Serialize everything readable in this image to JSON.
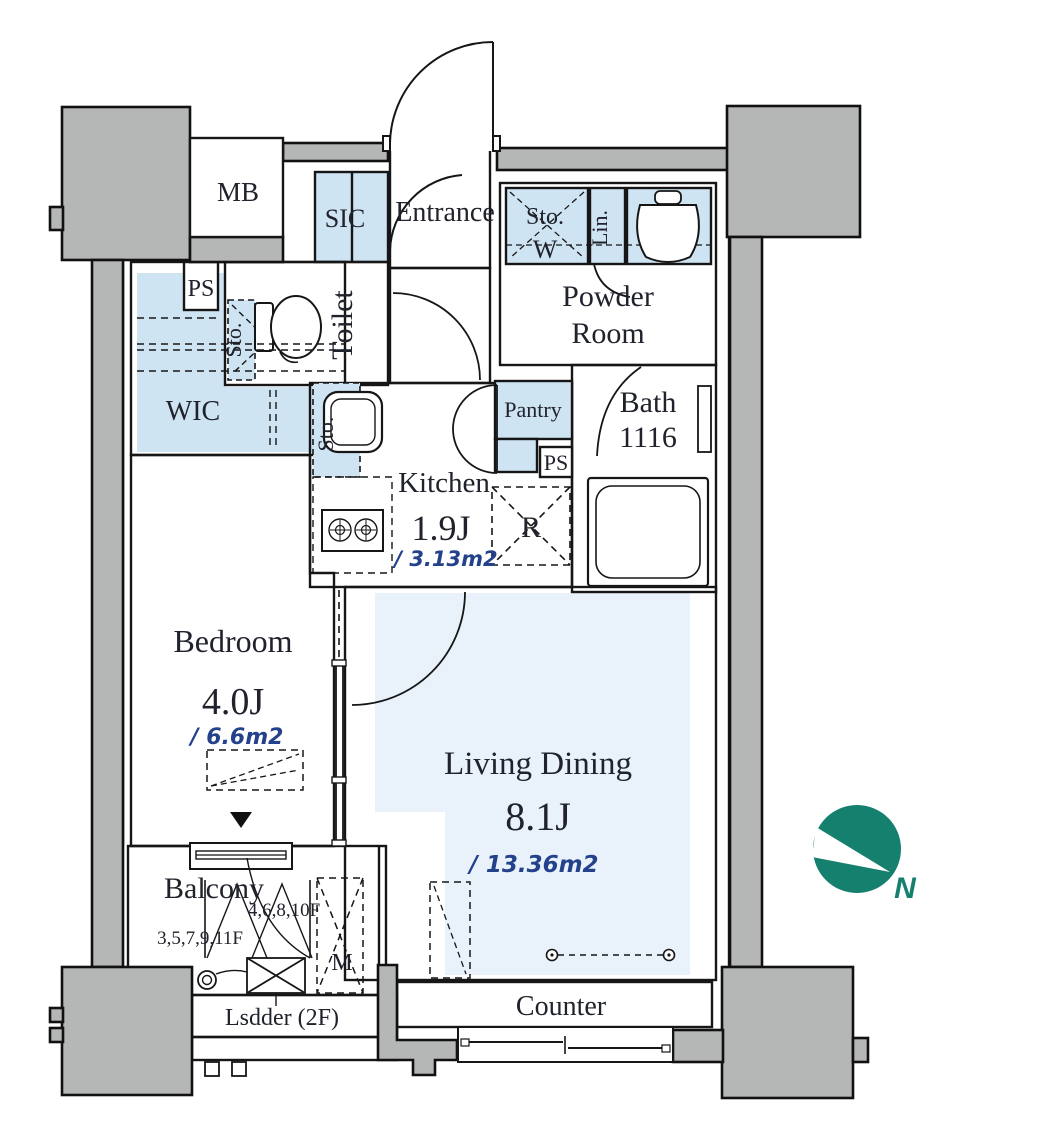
{
  "rooms": {
    "mb": {
      "label": "MB"
    },
    "sic": {
      "label": "SIC"
    },
    "entrance": {
      "label": "Entrance"
    },
    "toilet": {
      "label": "Toilet"
    },
    "toilet_storage": {
      "label": "Sto."
    },
    "ps_upper": {
      "label": "PS"
    },
    "wic": {
      "label": "WIC"
    },
    "kitchen_storage": {
      "label": "Sto."
    },
    "powder_room": {
      "line1": "Powder",
      "line2": "Room"
    },
    "powder_storage": {
      "label": "Sto.",
      "washer": "W"
    },
    "linen": {
      "label": "Lin."
    },
    "bath": {
      "label": "Bath",
      "size": "1116"
    },
    "pantry": {
      "label": "Pantry"
    },
    "ps_lower": {
      "label": "PS"
    },
    "refrigerator": {
      "label": "R"
    },
    "kitchen": {
      "label": "Kitchen",
      "size": "1.9J",
      "area": "/ 3.13m2"
    },
    "bedroom": {
      "label": "Bedroom",
      "size": "4.0J",
      "area": "/ 6.6m2"
    },
    "living_dining": {
      "label": "Living Dining",
      "size": "8.1J",
      "area": "/ 13.36m2"
    },
    "balcony": {
      "label": "Balcony",
      "floors_upper": "4,6,8,10F",
      "floors_lower": "3,5,7,9,11F"
    },
    "mechanical": {
      "label": "M"
    },
    "ladder": {
      "label": "Lsdder (2F)"
    },
    "counter": {
      "label": "Counter"
    }
  },
  "compass": {
    "label": "N"
  },
  "colors": {
    "concrete": "#b5b6b6",
    "closet_blue": "#cfe4f2",
    "floor_blue": "#e9f2fa",
    "wall": "#161616",
    "area_text": "#24418c",
    "compass_teal": "#15806e"
  }
}
